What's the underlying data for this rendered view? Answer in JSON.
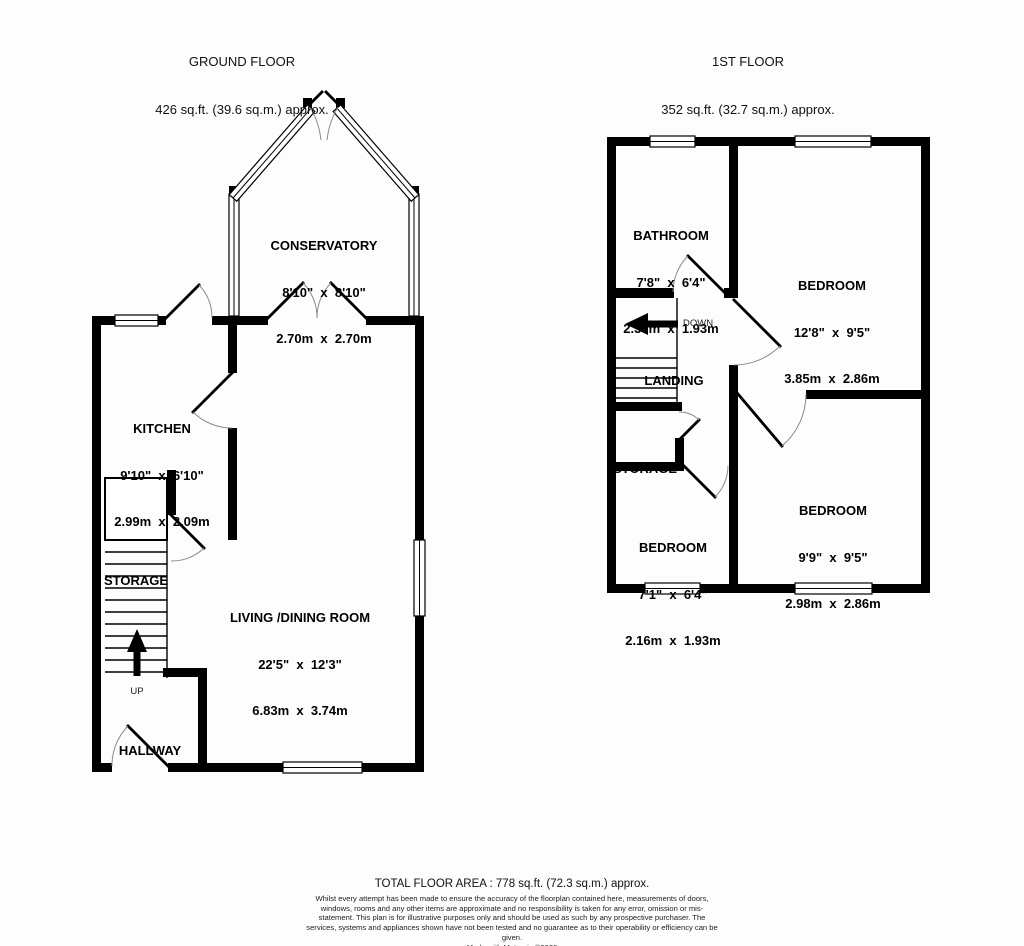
{
  "colors": {
    "wall": "#000000",
    "background": "#fdfdfd",
    "door_arc": "#8a8a8a"
  },
  "ground_floor": {
    "title": "GROUND FLOOR",
    "area": "426 sq.ft. (39.6 sq.m.) approx.",
    "stairs_label": "UP",
    "rooms": {
      "conservatory": {
        "name": "CONSERVATORY",
        "imperial": "8'10\"  x  8'10\"",
        "metric": "2.70m  x  2.70m"
      },
      "kitchen": {
        "name": "KITCHEN",
        "imperial": "9'10\"  x  6'10\"",
        "metric": "2.99m  x  2.09m"
      },
      "living_dining": {
        "name": "LIVING /DINING ROOM",
        "imperial": "22'5\"  x  12'3\"",
        "metric": "6.83m  x  3.74m"
      },
      "storage": {
        "name": "STORAGE"
      },
      "hallway": {
        "name": "HALLWAY"
      }
    }
  },
  "first_floor": {
    "title": "1ST FLOOR",
    "area": "352 sq.ft. (32.7 sq.m.) approx.",
    "stairs_label": "DOWN",
    "rooms": {
      "bathroom": {
        "name": "BATHROOM",
        "imperial": "7'8\"  x  6'4\"",
        "metric": "2.33m  x  1.93m"
      },
      "bedroom1": {
        "name": "BEDROOM",
        "imperial": "12'8\"  x  9'5\"",
        "metric": "3.85m  x  2.86m"
      },
      "bedroom2": {
        "name": "BEDROOM",
        "imperial": "7'1\"  x  6'4\"",
        "metric": "2.16m  x  1.93m"
      },
      "bedroom3": {
        "name": "BEDROOM",
        "imperial": "9'9\"  x  9'5\"",
        "metric": "2.98m  x  2.86m"
      },
      "landing": {
        "name": "LANDING"
      },
      "storage": {
        "name": "STORAGE"
      }
    }
  },
  "footer": {
    "total_area": "TOTAL FLOOR AREA : 778 sq.ft. (72.3 sq.m.) approx.",
    "disclaimer": "Whilst every attempt has been made to ensure the accuracy of the floorplan contained here, measurements of doors, windows, rooms and any other items are approximate and no responsibility is taken for any error, omission or mis-statement. This plan is for illustrative purposes only and should be used as such by any prospective purchaser. The services, systems and appliances shown have not been tested and no guarantee as to their operability or efficiency can be given.",
    "credit": "Made with Metropix ©2026"
  }
}
